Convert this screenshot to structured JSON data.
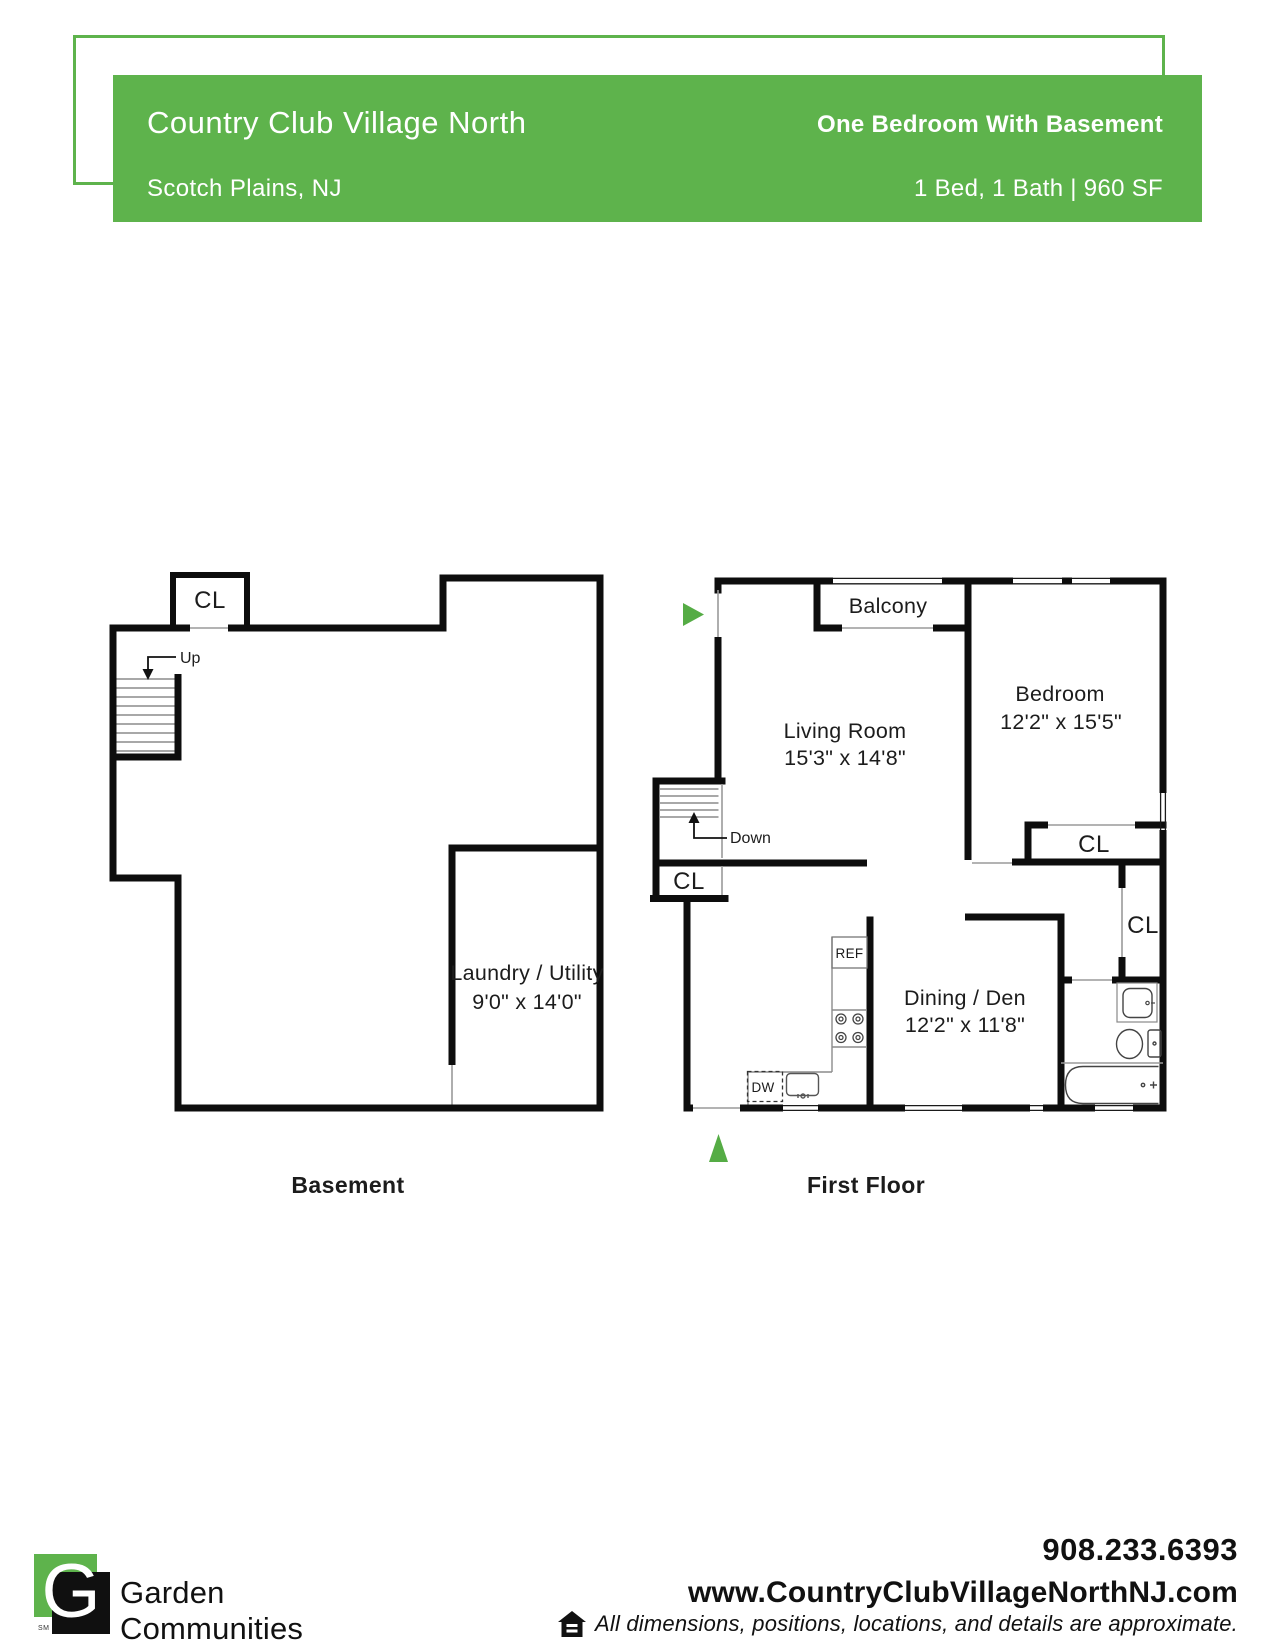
{
  "colors": {
    "brand_green": "#5eb34c",
    "entry_arrow_green": "#55ac45",
    "wall_black": "#0d0d0d",
    "opening_gray": "#9a9a9a"
  },
  "header": {
    "title": "Country Club Village North",
    "location": "Scotch Plains, NJ",
    "plan_name": "One Bedroom With Basement",
    "specs": "1 Bed, 1 Bath | 960 SF"
  },
  "basement": {
    "caption": "Basement",
    "closet_label": "CL",
    "stairs_label": "Up",
    "laundry": {
      "name": "Laundry / Utility",
      "dimensions": "9'0\" x 14'0\""
    }
  },
  "first_floor": {
    "caption": "First Floor",
    "balcony_label": "Balcony",
    "stairs_label": "Down",
    "entry_closet_label": "CL",
    "bedroom_closet_label": "CL",
    "hall_closet_label": "CL",
    "kitchen": {
      "refrigerator": "REF",
      "dishwasher": "DW"
    },
    "living_room": {
      "name": "Living Room",
      "dimensions": "15'3\" x 14'8\""
    },
    "bedroom": {
      "name": "Bedroom",
      "dimensions": "12'2\" x 15'5\""
    },
    "dining": {
      "name": "Dining / Den",
      "dimensions": "12'2\" x 11'8\""
    }
  },
  "footer": {
    "logo_letter": "G",
    "logo_mark": "SM",
    "company_line1": "Garden",
    "company_line2": "Communities",
    "phone": "908.233.6393",
    "website": "www.CountryClubVillageNorthNJ.com",
    "disclaimer": "All dimensions, positions, locations, and details are approximate."
  }
}
